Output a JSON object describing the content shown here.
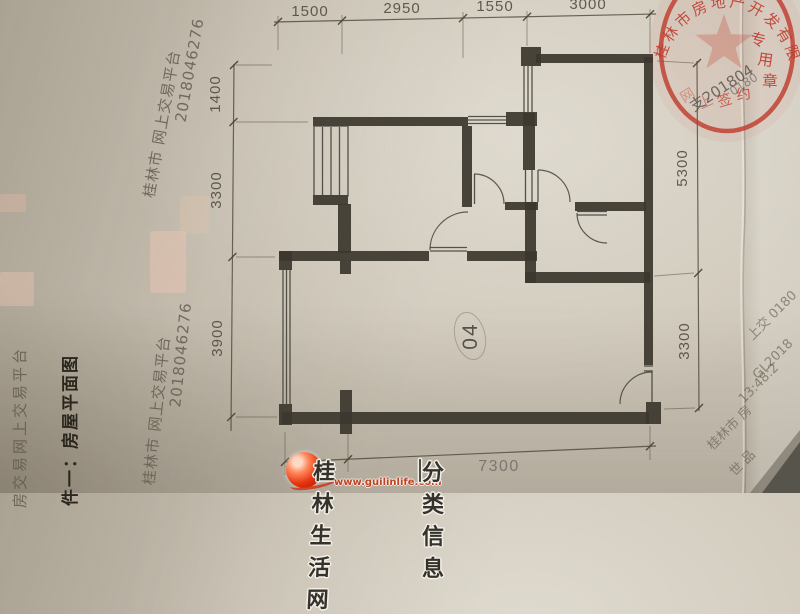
{
  "doc": {
    "attachment_title": "件一：房屋平面图"
  },
  "plan": {
    "unit_label": "04"
  },
  "dims": {
    "top": [
      "1500",
      "2950",
      "1550",
      "3000"
    ],
    "left": [
      "1400",
      "3300",
      "3900"
    ],
    "right": [
      "5300",
      "3300"
    ],
    "bottom": [
      "1500",
      "7300"
    ]
  },
  "watermarks": {
    "left_vertical": "房交易网上交易平台",
    "diag_line1": "桂林市 网上交易平台",
    "diag_line2": "2018046276",
    "side_notes": [
      "上交 0180",
      "GL2018",
      "13:48:2",
      "桂林市 房",
      "世 品"
    ]
  },
  "seal": {
    "company": "桂林市房地产开发有限公司",
    "bottom_chars": [
      "网",
      "上",
      "签",
      "约",
      "专",
      "用",
      "章"
    ],
    "overlay_a": "支201804",
    "overlay_b": "0180",
    "ring_color": "#bf3a2c"
  },
  "footer": {
    "site": "桂林生活网",
    "url": "www.guilinlife.com",
    "divider": "｜",
    "section": "分类信息",
    "logo_color": "#e03a12"
  }
}
